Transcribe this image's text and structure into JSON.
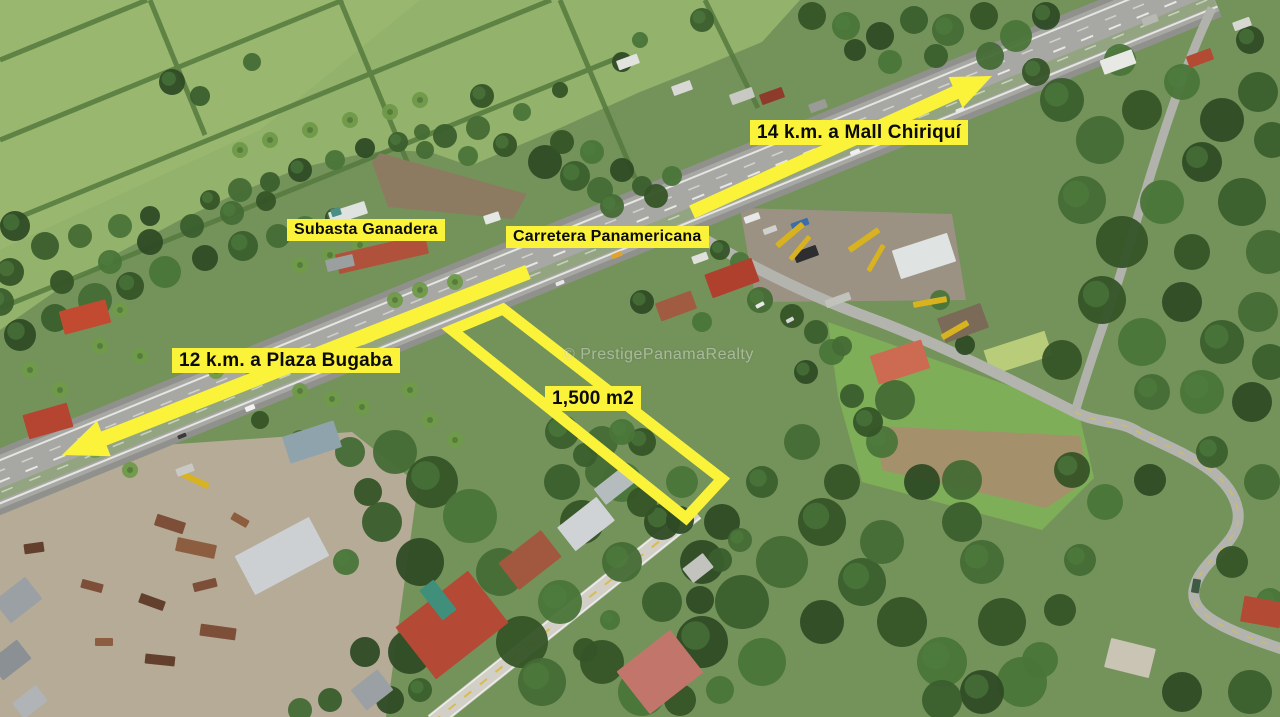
{
  "photo": {
    "kind": "annotated aerial drone photograph",
    "scene": "Roadside lot for sale beside the Pan-American Highway, surrounded by pastures, trees, houses and an equipment yard"
  },
  "annotations": {
    "accent_color": "#FBF33A",
    "label_text_color": "#0b0b0b",
    "labels": {
      "distance_northeast": "14 k.m. a Mall Chiriquí",
      "distance_southwest": "12 k.m. a Plaza Bugaba",
      "highway": "Carretera Panamericana",
      "landmark": "Subasta Ganadera",
      "parcel_area": "1,500 m2"
    },
    "arrows": [
      {
        "name": "arrow-northeast",
        "points_to": "Mall Chiriquí"
      },
      {
        "name": "arrow-southwest",
        "points_to": "Plaza Bugaba"
      }
    ],
    "parcel_outline": {
      "shape": "quadrilateral",
      "area_label": "1,500 m2"
    }
  },
  "watermark": {
    "text": "© PrestigePanamaRealty"
  }
}
